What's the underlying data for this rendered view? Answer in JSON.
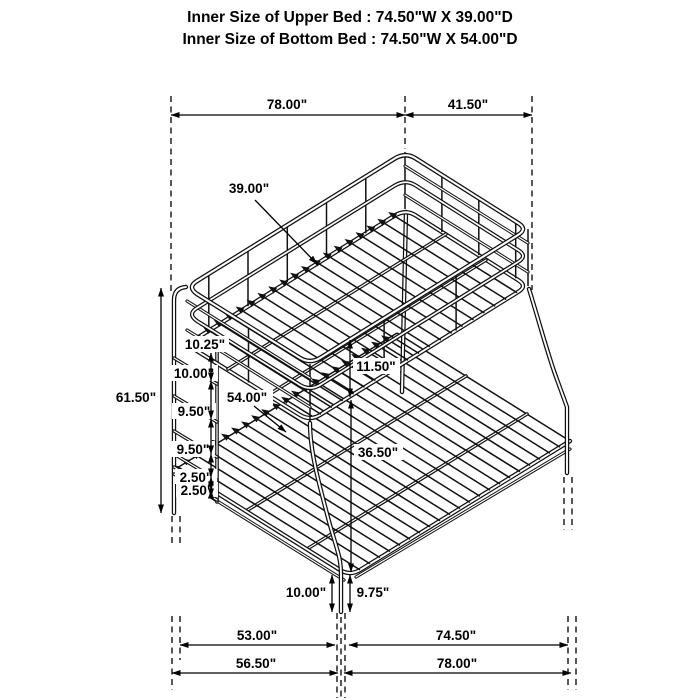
{
  "header": {
    "upper": "Inner Size of Upper Bed : 74.50\"W X 39.00\"D",
    "lower": "Inner Size of Bottom Bed : 74.50\"W X 54.00\"D"
  },
  "dimensions": {
    "top_width": "78.00\"",
    "top_overhang": "41.50\"",
    "upper_bed_depth": "39.00\"",
    "overall_height": "61.50\"",
    "ladder_gap_top": "10.25\"",
    "ladder_gap_2": "10.00\"",
    "ladder_gap_3": "9.50\"",
    "ladder_gap_4": "9.50\"",
    "ladder_gap_5": "2.50\"",
    "ladder_gap_6": "2.50\"",
    "lower_bed_depth": "54.00\"",
    "guardrail_height": "11.50\"",
    "under_bed_clearance": "36.50\"",
    "front_leg_height": "10.00\"",
    "front_leg_inner_height": "9.75\"",
    "floor_span_inner_left": "53.00\"",
    "floor_span_inner_right": "74.50\"",
    "floor_span_outer_left": "56.50\"",
    "floor_span_outer_right": "78.00\""
  },
  "colors": {
    "line": "#111111",
    "background": "#ffffff"
  }
}
